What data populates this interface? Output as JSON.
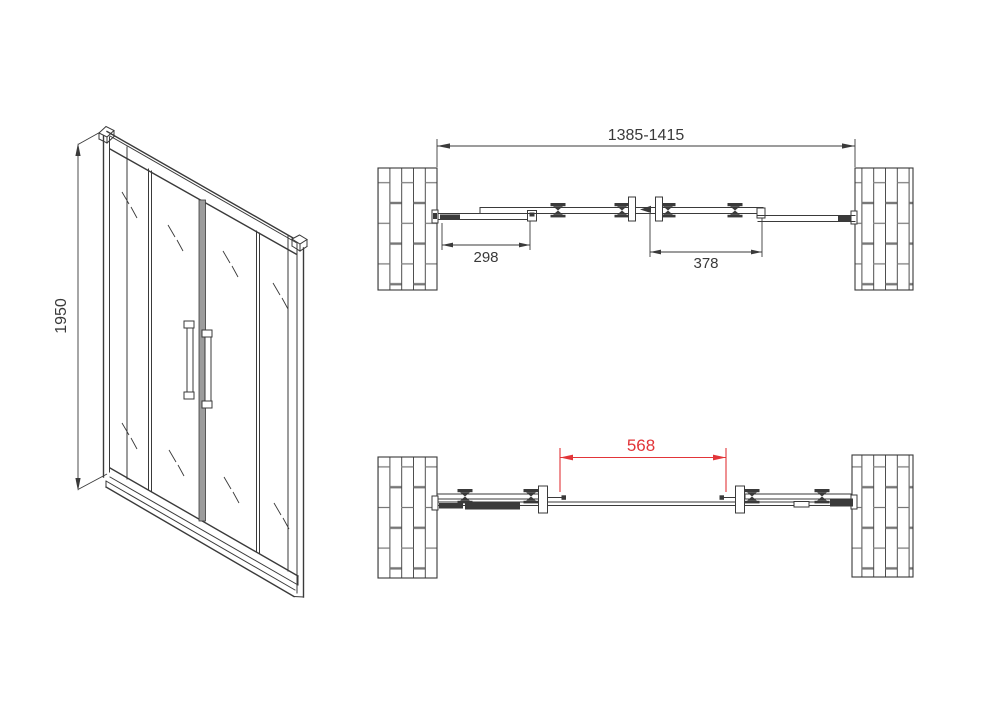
{
  "colors": {
    "line": "#3a3a3a",
    "accent_red": "#e23539",
    "mullion_gray": "#9c9c9c",
    "wall_joint": "#777777",
    "background": "#ffffff"
  },
  "front_view": {
    "height_label": "1950"
  },
  "plan_view_closed": {
    "overall_width_label": "1385-1415",
    "left_section_label": "298",
    "right_section_label": "378"
  },
  "plan_view_open": {
    "opening_label": "568"
  }
}
